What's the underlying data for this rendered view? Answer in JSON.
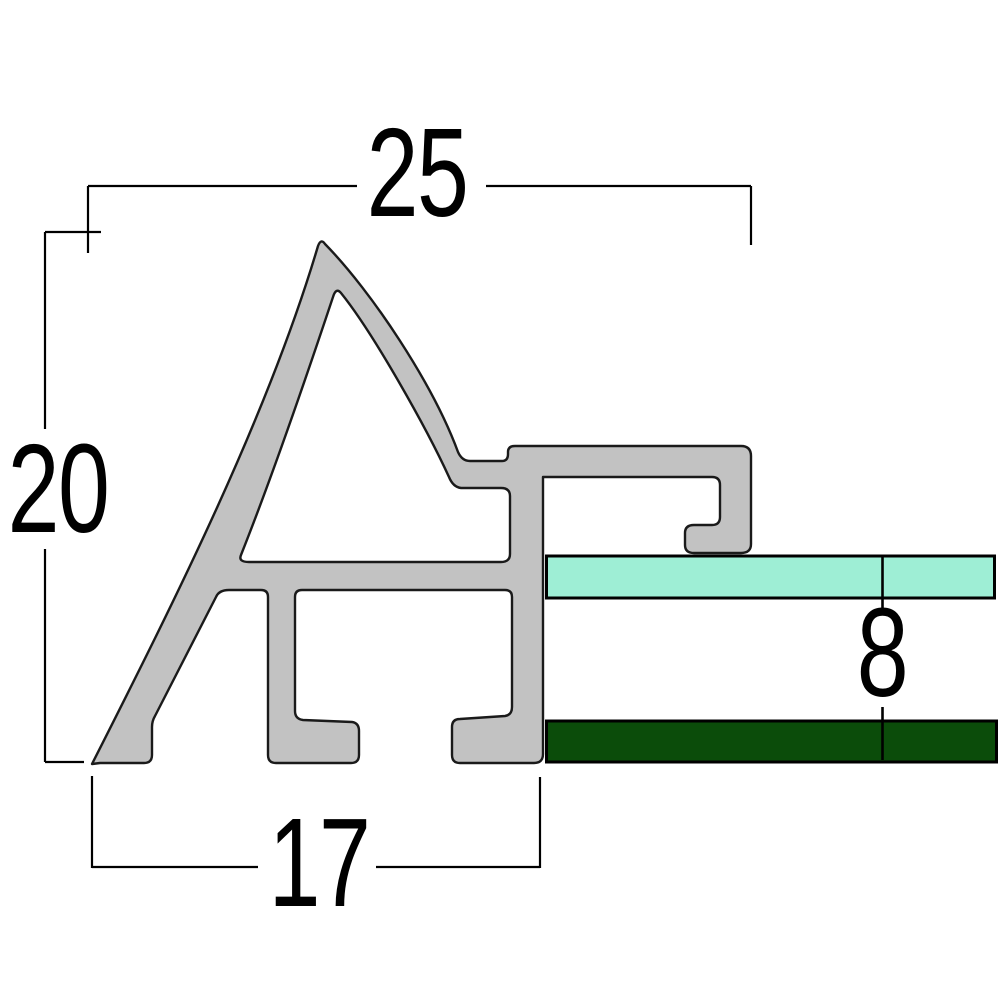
{
  "drawing": {
    "title": "frame profile cross-section",
    "dims": {
      "top": {
        "value": "25",
        "role": "overall width"
      },
      "left": {
        "value": "20",
        "role": "overall height"
      },
      "bottom": {
        "value": "17",
        "role": "base width"
      },
      "right": {
        "value": "8",
        "role": "panel-to-board gap"
      }
    },
    "parts": {
      "profile": {
        "label": "aluminum moulding profile"
      },
      "glass": {
        "label": "glazing panel"
      },
      "board": {
        "label": "back board"
      }
    },
    "colors": {
      "profile_fill": "#c2c2c2",
      "profile_stroke": "#1a1a1a",
      "glass_fill": "#9eeed5",
      "board_fill": "#0b4c0a",
      "line": "#000000",
      "background": "#ffffff"
    }
  }
}
